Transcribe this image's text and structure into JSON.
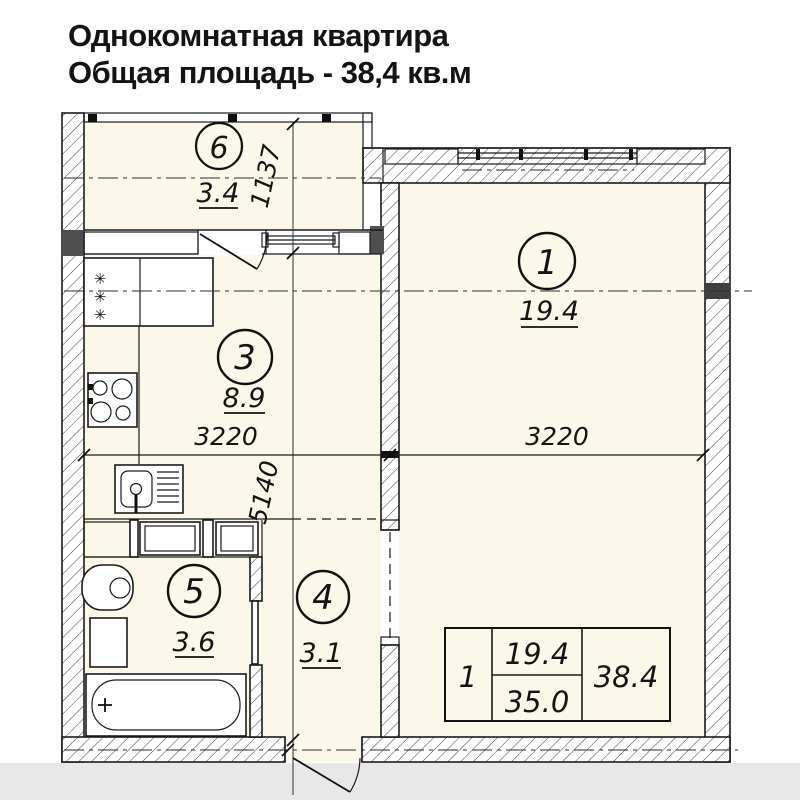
{
  "title": {
    "line1": "Однокомнатная квартира",
    "line2": "Общая площадь - 38,4 кв.м"
  },
  "plan": {
    "rooms": [
      {
        "id": "living-room",
        "number": "1",
        "area": "19.4"
      },
      {
        "id": "kitchen",
        "number": "3",
        "area": "8.9"
      },
      {
        "id": "hallway",
        "number": "4",
        "area": "3.1"
      },
      {
        "id": "bathroom",
        "number": "5",
        "area": "3.6"
      },
      {
        "id": "balcony",
        "number": "6",
        "area": "3.4"
      }
    ],
    "dimensions": {
      "balcony_depth": "1137",
      "kitchen_width": "3220",
      "living_width": "3220",
      "apartment_length": "5140"
    },
    "legend_table": {
      "rooms_count": "1",
      "living_area": "19.4",
      "rooms_area": "35.0",
      "total_area": "38.4"
    }
  },
  "icons": {
    "fridge_snowflake": "✳"
  },
  "colors": {
    "floor": "#fbf8ea",
    "line": "#1b1b1b",
    "footer_strip": "#e8e8e8",
    "dark_block": "#4f4f4f"
  }
}
